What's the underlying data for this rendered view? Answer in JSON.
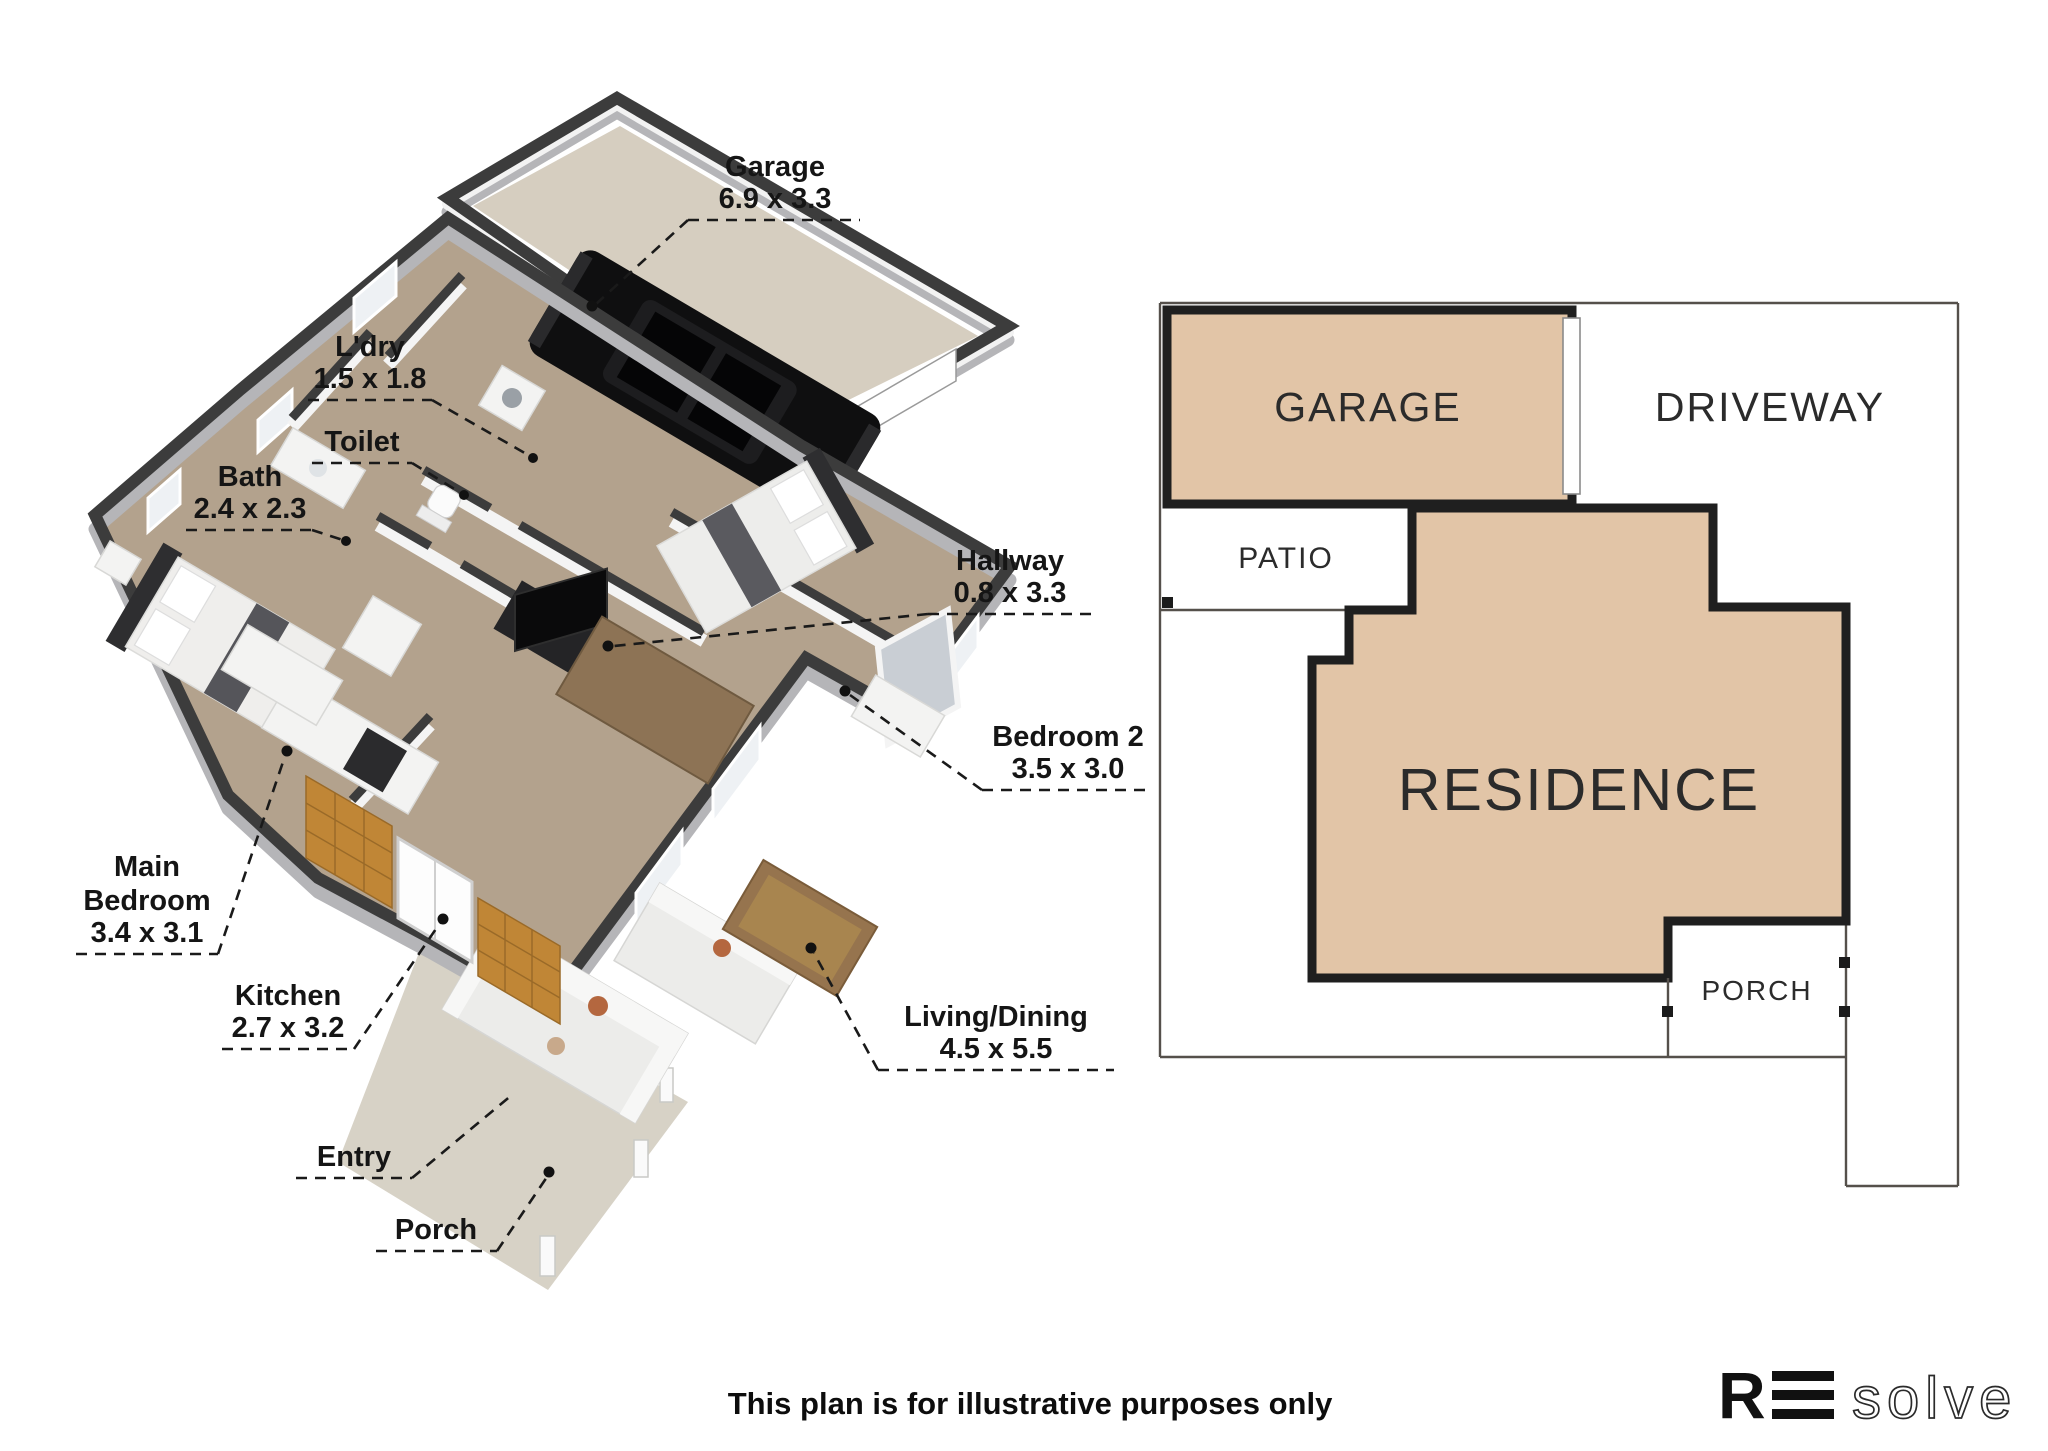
{
  "floor_plan_3d": {
    "labels": {
      "garage": {
        "name": "Garage",
        "dims": "6.9 x 3.3"
      },
      "laundry": {
        "name": "L'dry",
        "dims": "1.5 x 1.8"
      },
      "toilet": {
        "name": "Toilet"
      },
      "bath": {
        "name": "Bath",
        "dims": "2.4 x 2.3"
      },
      "hallway": {
        "name": "Hallway",
        "dims": "0.8 x 3.3"
      },
      "bedroom2": {
        "name": "Bedroom 2",
        "dims": "3.5 x 3.0"
      },
      "main_bedroom": {
        "lines": [
          "Main",
          "Bedroom"
        ],
        "dims": "3.4 x 3.1"
      },
      "kitchen": {
        "name": "Kitchen",
        "dims": "2.7 x 3.2"
      },
      "living_dining": {
        "name": "Living/Dining",
        "dims": "4.5 x 5.5"
      },
      "entry": {
        "name": "Entry"
      },
      "porch": {
        "name": "Porch"
      }
    }
  },
  "site_plan": {
    "garage_label": "GARAGE",
    "driveway_label": "DRIVEWAY",
    "patio_label": "PATIO",
    "residence_label": "RESIDENCE",
    "porch_label": "PORCH"
  },
  "footer": {
    "disclaimer": "This plan is for illustrative purposes only"
  },
  "logo": {
    "r": "R",
    "solve": "solve"
  },
  "colors": {
    "site_fill": "#e2c5a7",
    "site_border": "#1f1f1f",
    "boundary_line": "#55504b",
    "wall_dark": "#3c3c3c",
    "carpet": "#b3a28d",
    "garage_floor": "#d6cec0",
    "porch_floor": "#d7d2c6",
    "wood_wall": "#c08636"
  }
}
